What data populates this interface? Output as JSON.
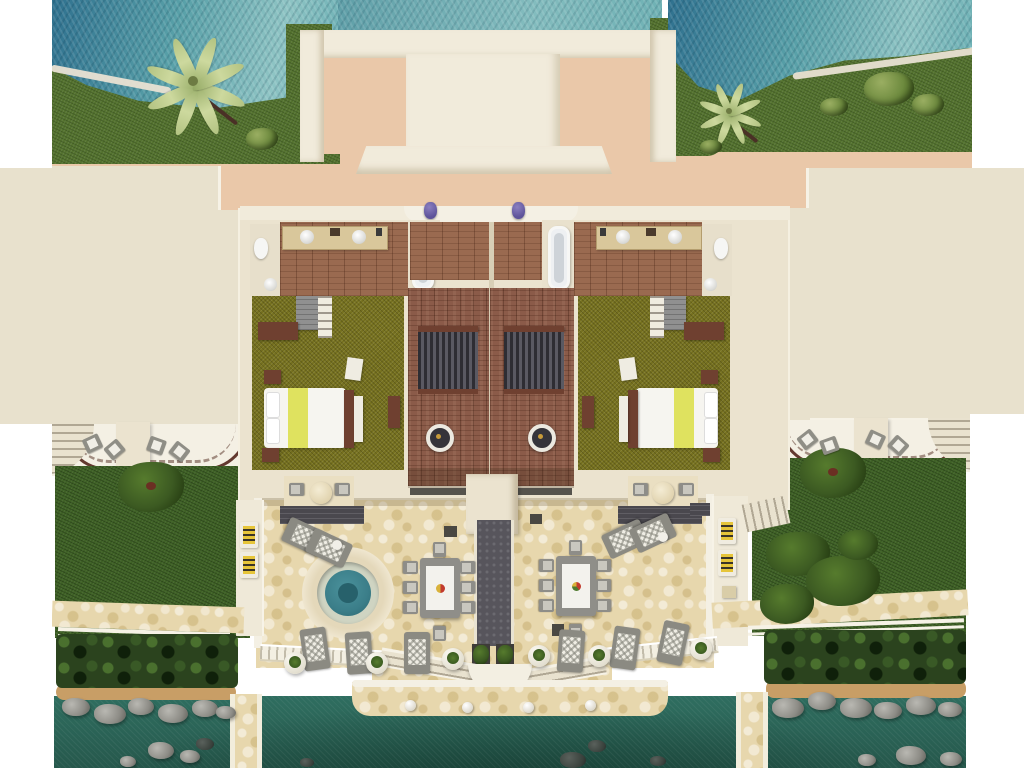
{
  "scene": {
    "title": "Top-down aerial 3D rendering of a twin beachfront villa floor plan with terrace, plunge pool and dock",
    "type": "architectural-3d-render",
    "view": "top-down",
    "villa_units": 2,
    "visible_text": "none"
  },
  "palette": {
    "sea_deep": "#2f718f",
    "harbor_water": "#2e6b5f",
    "grass": "#54722f",
    "lawn": "#3f6126",
    "hedge": "#2b431e",
    "sand_beach": "#e9e1d3",
    "sand_shore": "#c89e66",
    "salmon_ground": "#eac8a9",
    "roof_beige": "#e8e1cd",
    "wall_cream": "#ebe3cf",
    "roof_white": "#f0ead9",
    "stone_terrace": "#e7d7ad",
    "wood_bath": "#9a6a50",
    "wood_living": "#8b5b49",
    "carpet_olive": "#76711f",
    "vanity_tan": "#d9c79b",
    "furniture_brown": "#6f4030",
    "wardrobe_gray": "#909090",
    "slat_dark": "#2e2d33",
    "walkway_dark": "#57555c",
    "pool_teal": "#3b7e89",
    "pool_rim": "#cfd4c2",
    "bed_yellow_stripe": "#dfe25f",
    "cushion_yellow": "#e6c53a",
    "lounger_gray": "#8b8a82",
    "planter_white": "#f1efe8",
    "railing_brown": "#63392f",
    "rock_gray": "#8d8c86",
    "pot_purple": "#5d539a"
  },
  "inventory": {
    "plunge_pools": 1,
    "dining_tables": 2,
    "dining_chairs_per_table": 8,
    "sun_loungers_gray": 10,
    "striped_yellow_loungers": 4,
    "ball_planters": 6,
    "beds": 2,
    "bathtubs": 2,
    "vanity_sinks": 4,
    "toilets": 2,
    "dock_bollards": 4,
    "palm_trees": 2,
    "purple_planter_pots": 2
  }
}
